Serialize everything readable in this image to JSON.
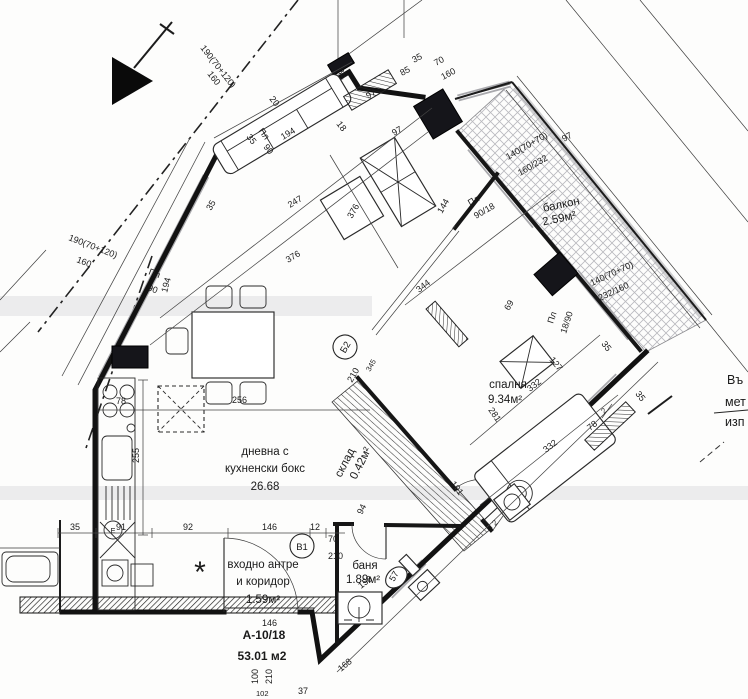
{
  "plan": {
    "unit": {
      "code": "А-10/18",
      "area": "53.01 м2"
    },
    "rooms": {
      "living": {
        "l1": "дневна с",
        "l2": "кухненски бокс",
        "area": "26.68"
      },
      "bedroom": {
        "name": "спалня",
        "area": "9.34м²"
      },
      "balcony": {
        "name": "балкон",
        "area": "2.59м²"
      },
      "bath": {
        "name": "баня",
        "area": "1.89м²"
      },
      "storage": {
        "name": "склад",
        "area": "0.42м²"
      },
      "hall": {
        "l1": "входно антре",
        "l2": "и коридор",
        "area": "1.59м²"
      }
    },
    "doors": {
      "b1": "В1",
      "b2": "Б2"
    },
    "windows": {
      "w190a": {
        "l1": "190(70+120)",
        "l2": "160"
      },
      "w190b": {
        "l1": "190(70+120)",
        "l2": "160"
      },
      "w70": {
        "l1": "70",
        "l2": "160"
      },
      "w140a": {
        "l1": "140(70+70)",
        "l2": "160/232"
      },
      "w140b": {
        "l1": "140(70+70)",
        "l2": "232/160"
      },
      "plLeft": {
        "l1": "Пл",
        "l2": "90"
      },
      "plMid": {
        "l1": "Пл",
        "l2": "90"
      },
      "plTop": {
        "l1": "Пл",
        "l2": "90/18"
      },
      "plBed": {
        "l1": "Пл",
        "l2": "18/90"
      }
    },
    "dims": {
      "d35": "35",
      "d20": "20",
      "d97": "97",
      "d85": "85",
      "d18": "18",
      "d194": "194",
      "d247": "247",
      "d376": "376",
      "d144": "144",
      "d344": "344",
      "d69": "69",
      "d127": "127",
      "d332": "332",
      "d281": "281",
      "d345": "345",
      "d210": "210",
      "d256": "256",
      "d255": "255",
      "d78": "78",
      "d91": "91",
      "d92": "92",
      "d146": "146",
      "d12": "12",
      "d70": "70",
      "d158": "158",
      "d57": "57",
      "d94": "94",
      "d191": "191",
      "d168": "168",
      "d100": "100",
      "d102": "102",
      "d37": "37",
      "d2": "2"
    },
    "symbols": {
      "snowflake": "*",
      "boiler": "Е"
    },
    "notes": {
      "r1": "Въ",
      "r2": "мет",
      "r3": "изп"
    }
  }
}
